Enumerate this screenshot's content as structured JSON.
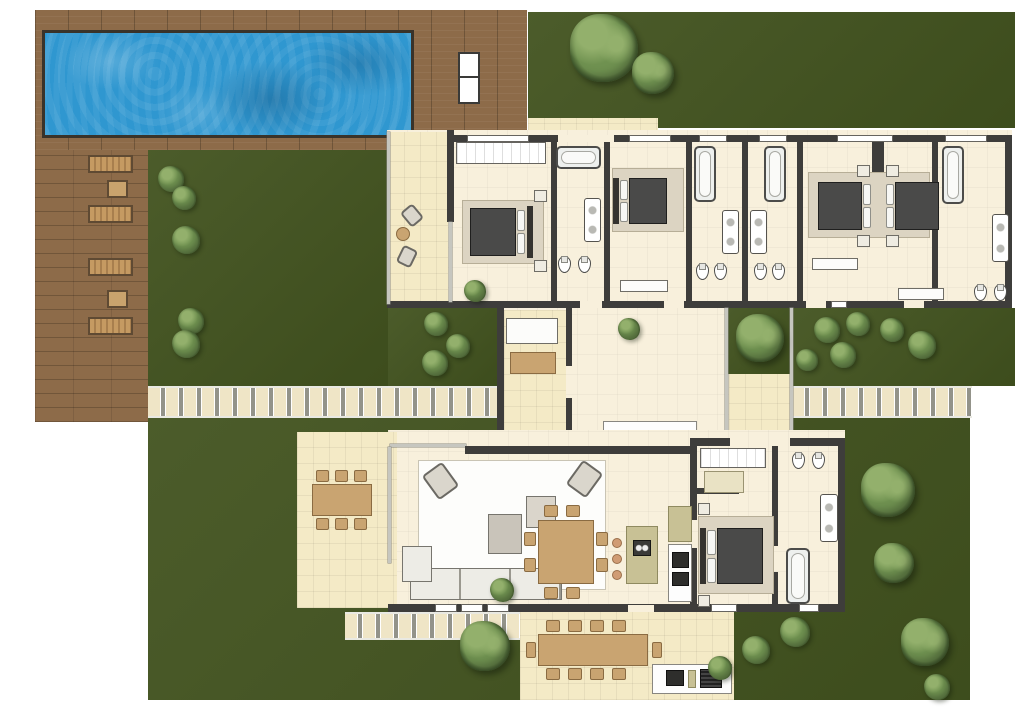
{
  "scene": {
    "type": "architectural floor plan, top-down 3D render",
    "subject": "single-storey villa with pool, garden and terraces",
    "visible_text": "none"
  },
  "palette": {
    "lawn": "#42531f",
    "deck": "#8d6b49",
    "water": "#2f97d0",
    "wall": "#3e3d3b",
    "floor": "#f8f0dc",
    "terr": "#f4eac6",
    "stone": "#efe5c6",
    "pathgap": "#93938a",
    "rug": "#dcd4c2",
    "matt": "#4a4a49",
    "wood": "#c9a471",
    "wood_d": "#8a6b42",
    "whitef": "#fdfdfd",
    "island": "#c8c195",
    "stool": "#d09c74",
    "tree_d": "#3c5428",
    "tree_m": "#6f9150",
    "tree_l": "#93b06c",
    "uph": "#d8d3c9"
  },
  "site": {
    "pool_area": {
      "pool": "rectangular swimming pool",
      "deck": "L-shaped wooden deck",
      "white_pool_lounger": 1,
      "wooden_sun_loungers": 4,
      "side_tables": 2
    },
    "garden": {
      "lawn_patches": 5,
      "trees": 8,
      "shrubs": 17,
      "stepping_stone_paths": 3,
      "courtyard_tree": 1
    },
    "terraces": {
      "covered_terrace": [
        "2 lounge chairs",
        "round table"
      ],
      "west_terrace_dining_seats": 6,
      "south_terrace_dining_seats": 10,
      "outdoor_kitchen": [
        "counter",
        "cooktop",
        "grill"
      ]
    }
  },
  "house": {
    "north_wing": [
      {
        "room": "covered terrace",
        "items": [
          "lounge chair",
          "lounge chair",
          "round table"
        ]
      },
      {
        "room": "bedroom 1",
        "items": [
          "wardrobe",
          "double bed",
          "2 nightstands",
          "rug",
          "plant"
        ]
      },
      {
        "room": "bathroom 1",
        "items": [
          "bathtub",
          "double sink",
          "2 toilets"
        ]
      },
      {
        "room": "bedroom 2",
        "items": [
          "double bed",
          "bench",
          "rug"
        ]
      },
      {
        "room": "bathroom 2",
        "items": [
          "bathtub",
          "double sink",
          "2 toilets"
        ]
      },
      {
        "room": "bathroom 3",
        "items": [
          "bathtub",
          "double sink",
          "2 toilets"
        ]
      },
      {
        "room": "bedroom 3-4",
        "items": [
          "two beds head-to-head",
          "shared rug",
          "4 nightstands",
          "2 benches"
        ]
      },
      {
        "room": "bathroom 4",
        "items": [
          "bathtub",
          "double sink",
          "2 toilets"
        ]
      }
    ],
    "center": [
      {
        "room": "entry hall",
        "items": [
          "bench",
          "coffee table",
          "plant",
          "console",
          "L-counter"
        ]
      },
      {
        "room": "inner courtyard",
        "items": [
          "tree",
          "tiled patio"
        ]
      }
    ],
    "south_wing": [
      {
        "room": "living room",
        "items": [
          "area rug",
          "2 armchairs",
          "2 coffee tables",
          "corner sofa",
          "plant"
        ]
      },
      {
        "room": "dining area",
        "items": [
          "square table",
          "8 chairs"
        ]
      },
      {
        "room": "kitchen",
        "items": [
          "island with sink",
          "3 bar stools",
          "tall cabinet",
          "appliance counter"
        ]
      },
      {
        "room": "walk-in closet",
        "items": [
          "wardrobe",
          "bench"
        ]
      },
      {
        "room": "master bedroom",
        "items": [
          "double bed",
          "rug",
          "2 nightstands"
        ]
      },
      {
        "room": "master bathroom",
        "items": [
          "bathtub",
          "double sink",
          "2 toilets"
        ]
      }
    ]
  }
}
